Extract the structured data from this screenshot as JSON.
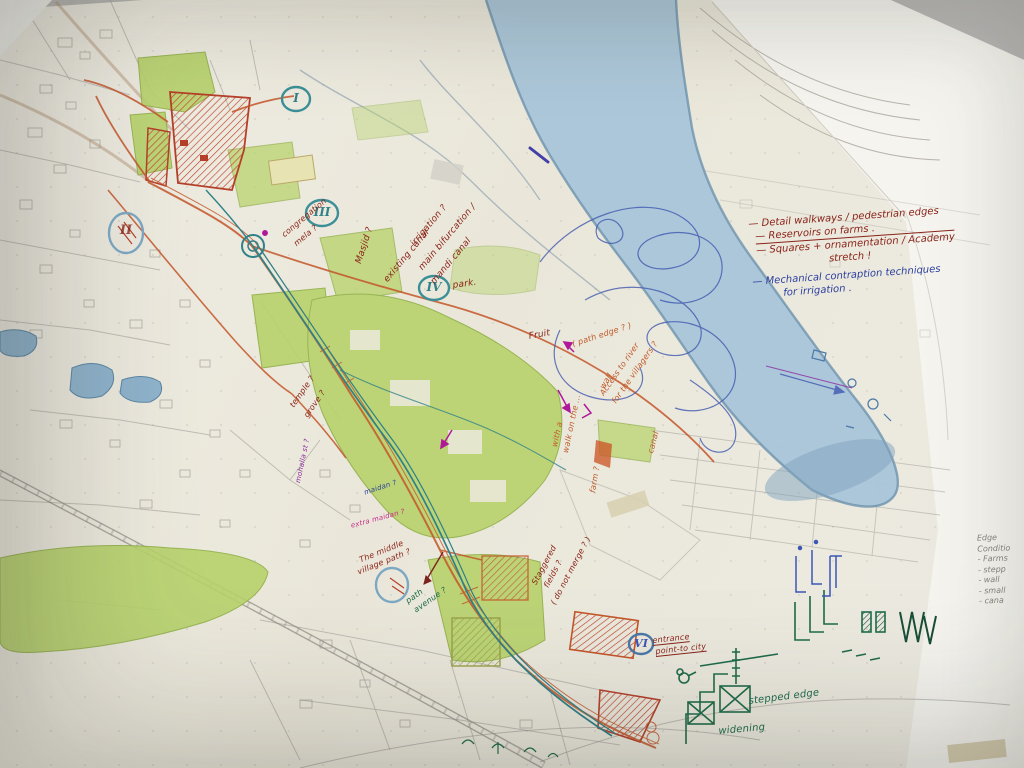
{
  "palette": {
    "trace_paper": "#ece9dd",
    "under_paper": "#f5f4ef",
    "desk": "#b9b8b6",
    "river_blue": "#a9c5d9",
    "green_pencil": "#b7d26a",
    "orange_road": "#c4562a",
    "teal_canal": "#2f8188",
    "red_ink": "#8a2318",
    "blue_ink": "#2b3f9e",
    "green_ink": "#1e6b4a",
    "purple": "#8a2aa0",
    "pencil_gray": "#a2a09a"
  },
  "notes_top_right": {
    "line1": "— Detail walkways / pedestrian edges",
    "line2": "— Reservoirs on farms .",
    "line3": "— Squares + ornamentation / Academy",
    "line4": "stretch !",
    "line5": "— Mechanical contraption techniques",
    "line6": "for irrigation ."
  },
  "edge_conditions": {
    "title1": "Edge",
    "title2": "Conditio",
    "item1": "- Farms",
    "item2": "- stepp",
    "item3": "- wall",
    "item4": "- small",
    "item5": "- cana"
  },
  "markers": {
    "numeral_i": "I",
    "numeral_ii": "II",
    "numeral_iii": "III",
    "numeral_iv": "IV",
    "numeral_vi": "VI",
    "park_label": "park."
  },
  "map_annotations": {
    "masjid": "Masjid ?",
    "existing_canal": "existing canal",
    "irrigation": "irrigation ?",
    "main_bifurcation": "main bifurcation /",
    "mandi_canal": "mandi canal",
    "congregation_1": "congregation",
    "congregation_2": "mela ?",
    "fruit": "Fruit",
    "path_edge": "( path edge ? )",
    "access_river_1": "Access to river",
    "access_river_2": "for the villagers ?",
    "wall": "wall",
    "walk_side_1": "with a",
    "walk_side_2": "walk on the ...",
    "farm": "farm ?",
    "canal": "canal",
    "temple": "temple ?",
    "grove": "grove ?",
    "mohalla": "mohalla st ?",
    "maidan": "maidan ?",
    "extra_maidan": "extra maidan ?",
    "middle_village_1": "The middle",
    "middle_village_2": "village path ?",
    "path_avenue_1": "path",
    "path_avenue_2": "avenue ?",
    "staggered_1": "Staggered",
    "staggered_2": "fields ?",
    "staggered_3": "( do not merge ? )",
    "entrance_1": "entrance",
    "entrance_2": "point-to city",
    "stepped_edge": "stepped edge",
    "widening": "widening"
  }
}
